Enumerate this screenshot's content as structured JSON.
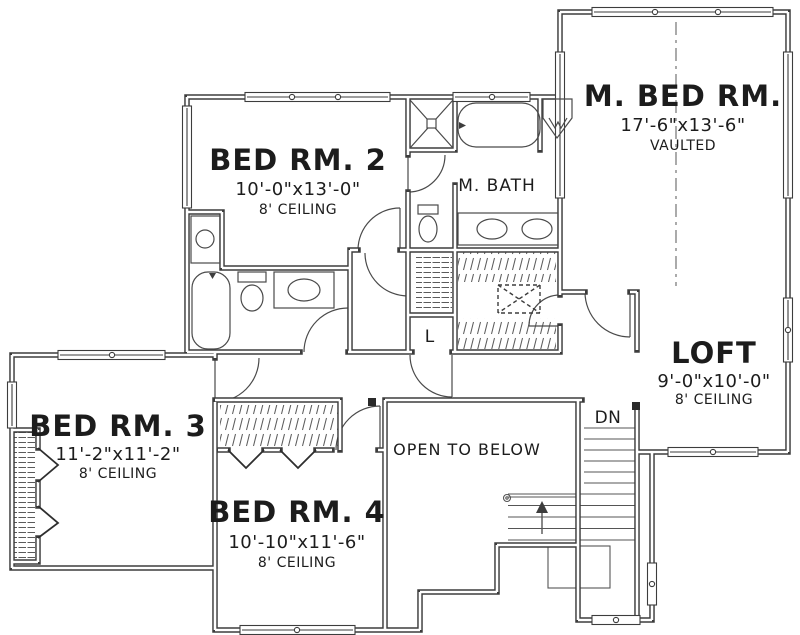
{
  "plan": {
    "colors": {
      "wall": "#3d3d3d",
      "line": "#555555",
      "text": "#1c1c1c",
      "background": "#ffffff"
    },
    "rooms": [
      {
        "name": "BED RM. 2",
        "dims": "10'-0\"x13'-0\"",
        "ceiling": "8' CEILING"
      },
      {
        "name": "M. BATH"
      },
      {
        "name": "M. BED RM.",
        "dims": "17'-6\"x13'-6\"",
        "ceiling": "VAULTED"
      },
      {
        "name": "LOFT",
        "dims": "9'-0\"x10'-0\"",
        "ceiling": "8' CEILING"
      },
      {
        "name": "BED RM. 3",
        "dims": "11'-2\"x11'-2\"",
        "ceiling": "8' CEILING"
      },
      {
        "name": "BED RM. 4",
        "dims": "10'-10\"x11'-6\"",
        "ceiling": "8' CEILING"
      }
    ],
    "labels": {
      "open_to_below": "OPEN TO BELOW",
      "stairs_down": "DN",
      "linen_closet": "L"
    }
  }
}
